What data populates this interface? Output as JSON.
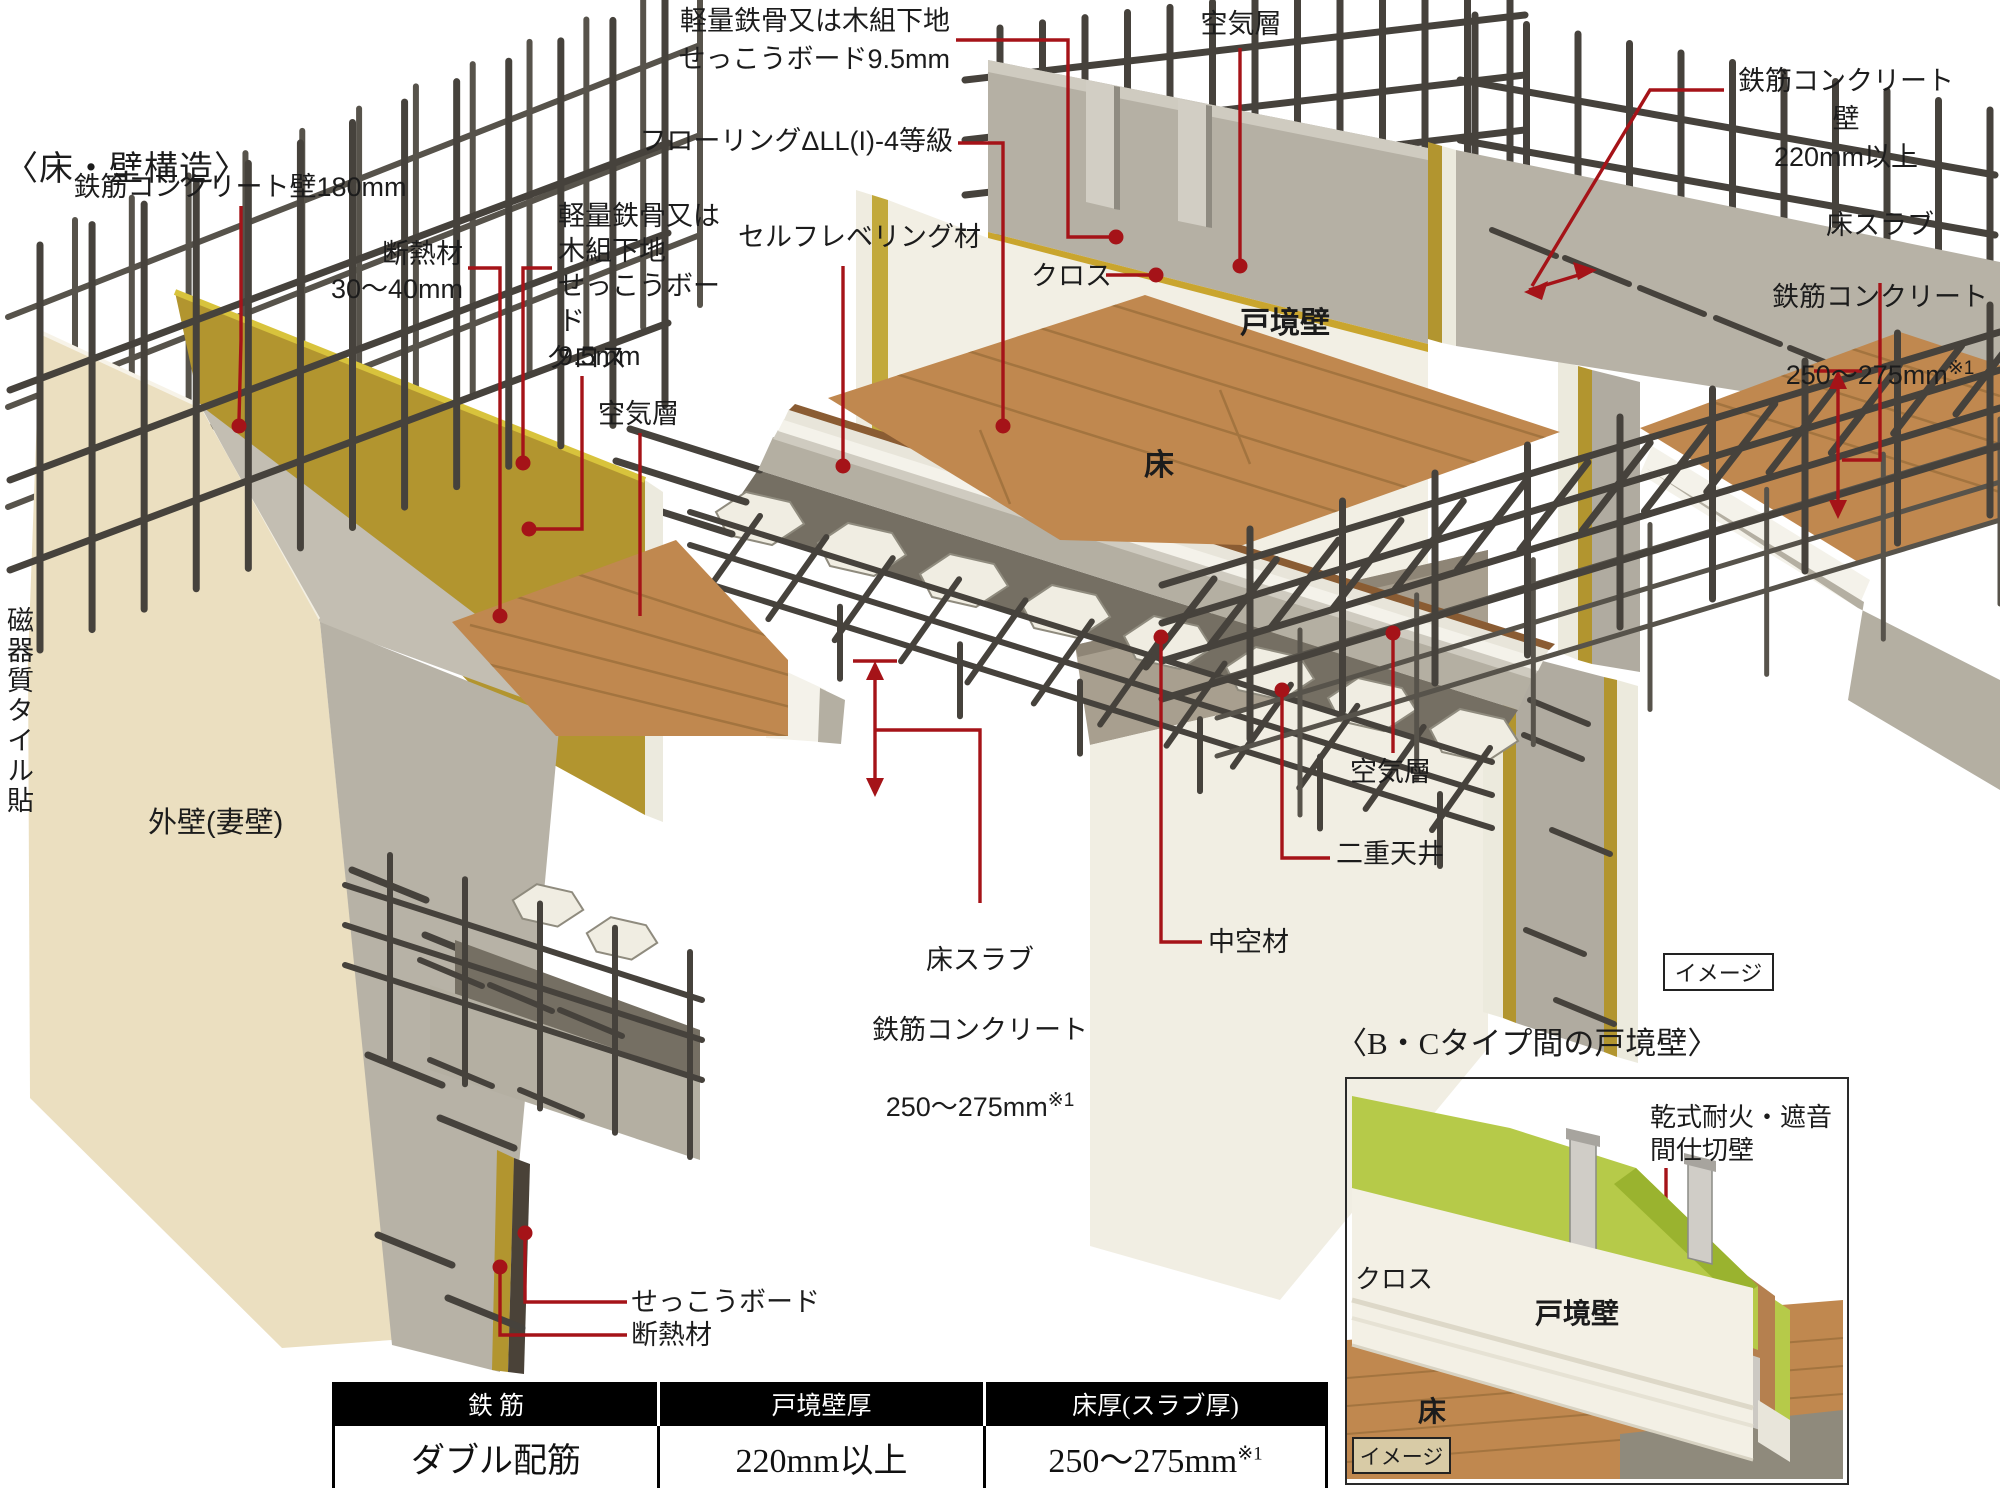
{
  "headings": {
    "main": "〈床・壁構造〉",
    "inset": "〈B・Cタイプ間の戸境壁〉"
  },
  "callouts": {
    "rc_wall_180": "鉄筋コンクリート壁180mm",
    "insulation_upper": "断熱材\n30〜40mm",
    "lgs_board_left": "軽量鉄骨又は\n木組下地\nせっこうボード\n9.5mm",
    "cross_left": "クロス",
    "air_layer_left": "空気層",
    "lgs_board_top": "軽量鉄骨又は木組下地\nせっこうボード9.5mm",
    "flooring_grade": "フローリングΔLL(I)-4等級",
    "self_leveling": "セルフレベリング材",
    "cross_center": "クロス",
    "air_layer_top": "空気層",
    "rc_wall_220": "鉄筋コンクリート壁\n220mm以上",
    "slab_right": {
      "l1": "床スラブ",
      "l2": "鉄筋コンクリート",
      "l3": "250〜275mm",
      "sup": "※1"
    },
    "air_layer_right": "空気層",
    "double_ceiling": "二重天井",
    "hollow_material": "中空材",
    "slab_center": {
      "l1": "床スラブ",
      "l2": "鉄筋コンクリート",
      "l3": "250〜275mm",
      "sup": "※1"
    },
    "gypsum_board_bottom": "せっこうボード",
    "insulation_bottom": "断熱材",
    "tile_vertical": "磁器質タイル貼",
    "exterior_wall": "外壁(妻壁)"
  },
  "figure_labels": {
    "partition_wall": "戸境壁",
    "floor": "床",
    "image_tag": "イメージ"
  },
  "inset": {
    "partition_label": "乾式耐火・遮音\n間仕切壁",
    "cross": "クロス",
    "wall": "戸境壁",
    "floor": "床",
    "image_tag": "イメージ"
  },
  "table": {
    "headers": [
      "鉄 筋",
      "戸境壁厚",
      "床厚(スラブ厚)"
    ],
    "row": {
      "c1": "ダブル配筋",
      "c2": "220mm以上",
      "c3": "250〜275mm",
      "c3_sup": "※1"
    }
  },
  "colors": {
    "callout_red": "#a51318",
    "table_header_bg": "#000000",
    "wood": "#c0884f",
    "insulation_yellow": "#b2952f",
    "inset_green": "#b6ca49",
    "concrete": "#b4afa2",
    "cream_wall": "#ebdfc0"
  }
}
